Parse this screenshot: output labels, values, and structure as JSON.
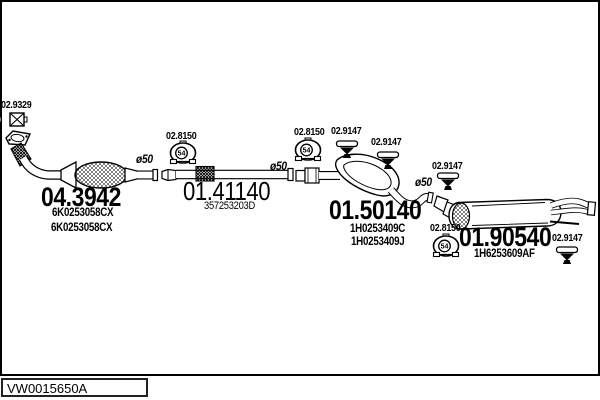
{
  "parts": {
    "flange_gasket": {
      "code": "02.9329"
    },
    "front_pipe_catalyst": {
      "code": "04.3942",
      "part_numbers": [
        "6K0253058CX",
        "6K0253058CX"
      ]
    },
    "center_pipe": {
      "code": "01.41140",
      "part_number": "357253203D"
    },
    "center_muffler": {
      "code": "01.50140",
      "part_numbers": [
        "1H0253409C",
        "1H0253409J"
      ]
    },
    "rear_muffler": {
      "code": "01.90540",
      "part_number": "1H6253609AF"
    },
    "clamp": {
      "code": "02.8150",
      "size": "54"
    },
    "hanger": {
      "code": "02.9147"
    },
    "pipe_diameter": "ø50"
  },
  "footer": {
    "drawing_code": "VW0015650A"
  },
  "colors": {
    "line": "#000000",
    "background": "#ffffff"
  }
}
